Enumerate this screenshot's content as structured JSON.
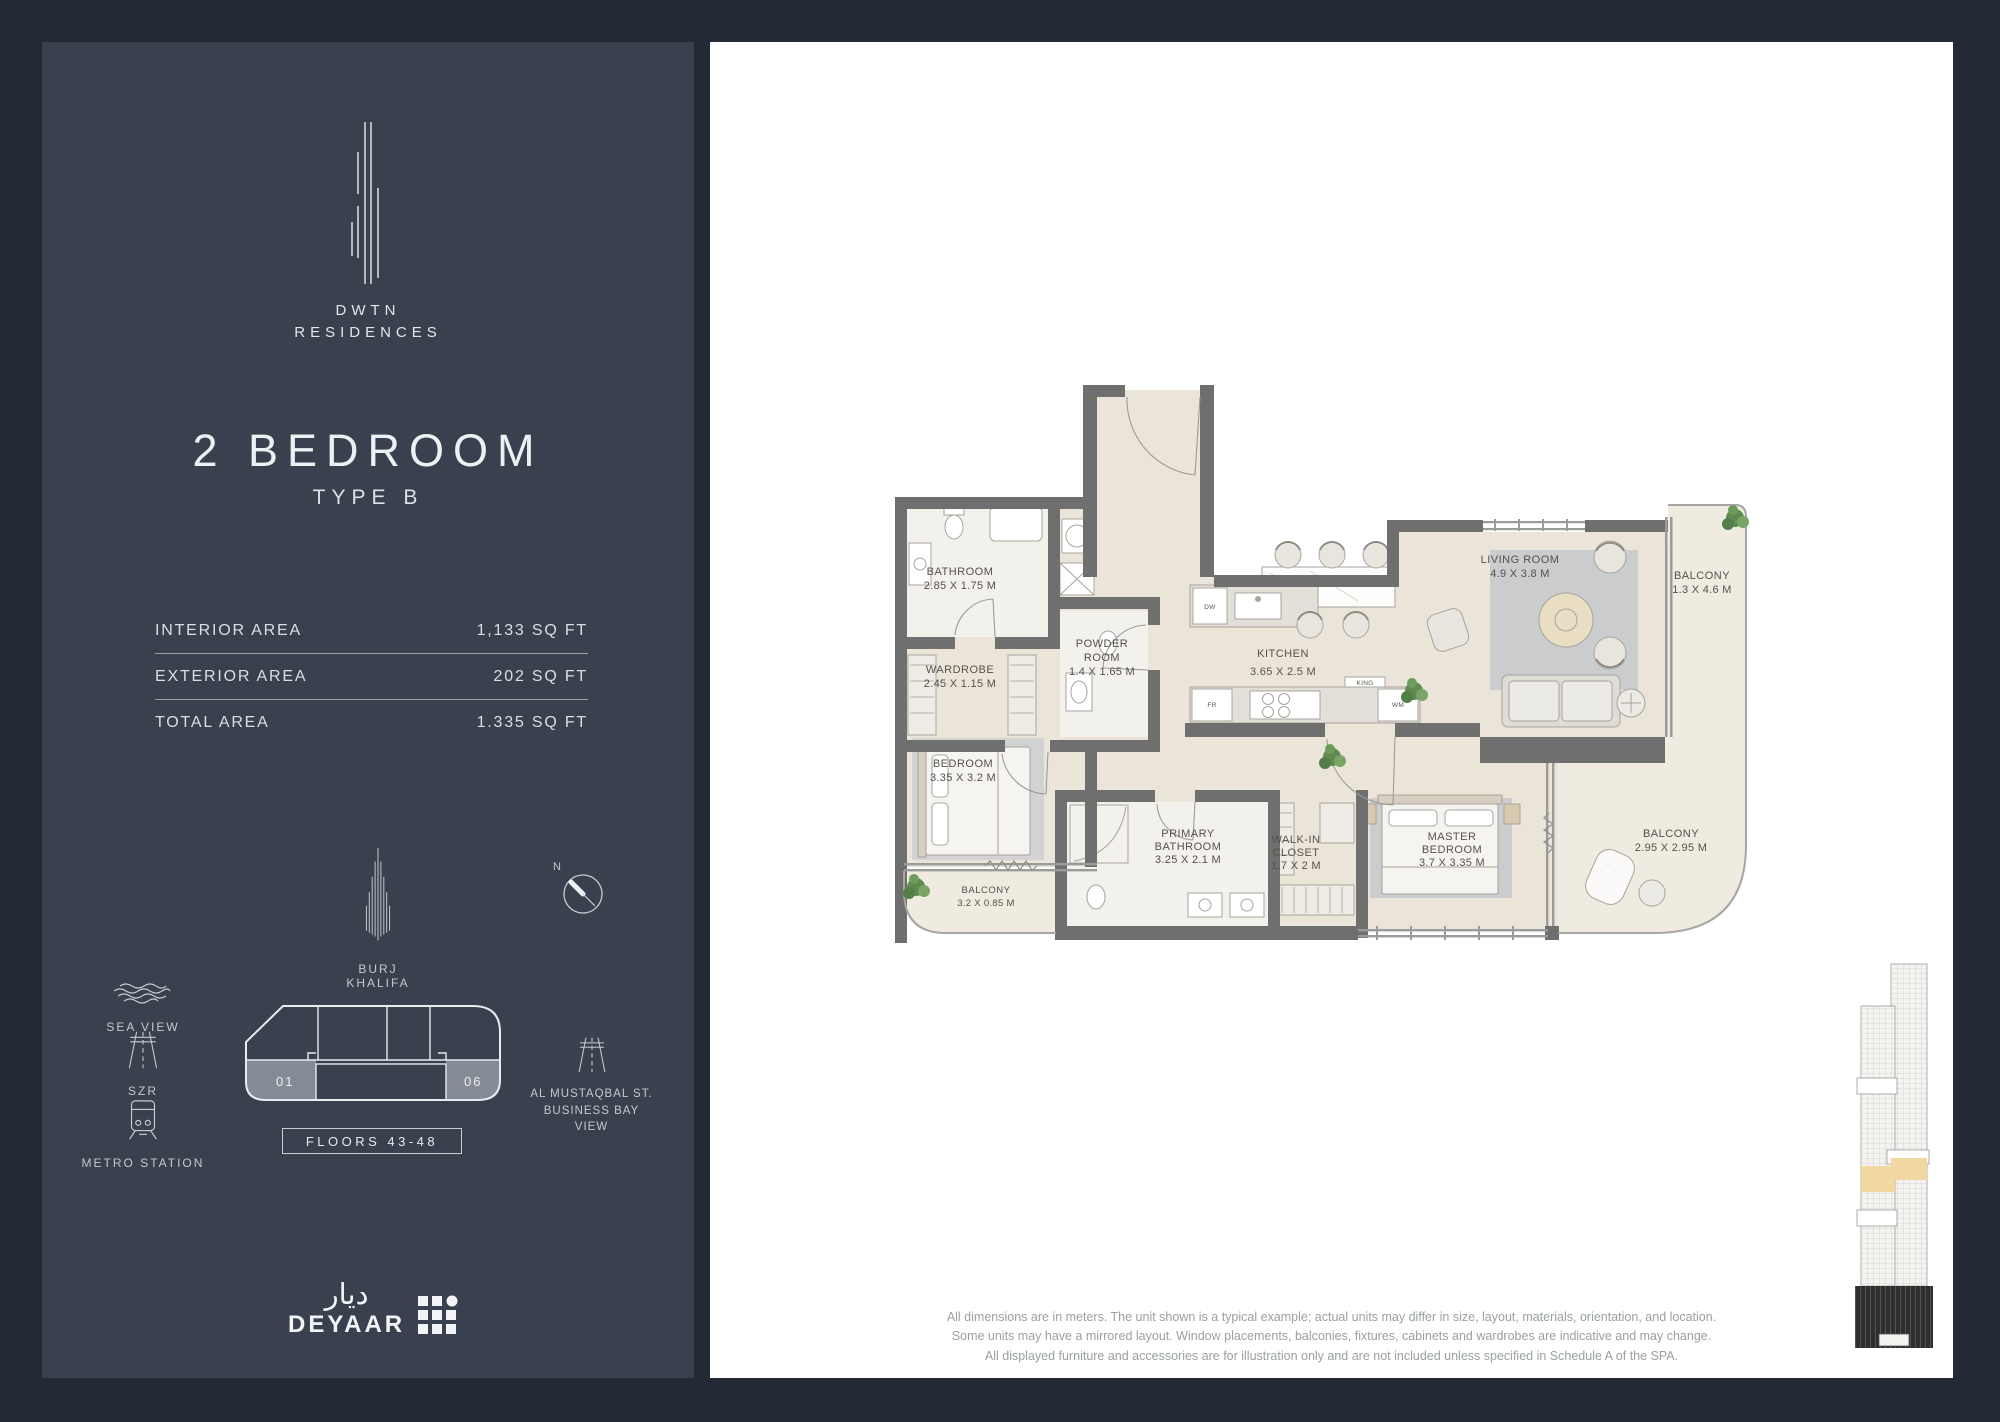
{
  "sidebar": {
    "brand_line1": "DWTN",
    "brand_line2": "RESIDENCES",
    "unit_title": "2 BEDROOM",
    "unit_subtitle": "TYPE B",
    "area_table": {
      "rows": [
        {
          "label": "INTERIOR AREA",
          "value": "1,133  SQ FT"
        },
        {
          "label": "EXTERIOR AREA",
          "value": "202  SQ FT"
        },
        {
          "label": "TOTAL AREA",
          "value": "1.335  SQ FT"
        }
      ]
    },
    "landmark_label": "BURJ KHALIFA",
    "compass_north": "N",
    "context_items": [
      {
        "icon": "sea-waves-icon",
        "label": "SEA VIEW"
      },
      {
        "icon": "highway-icon",
        "label": "SZR"
      },
      {
        "icon": "metro-train-icon",
        "label": "METRO STATION"
      }
    ],
    "floorplate": {
      "unit_left": "01",
      "unit_right": "06",
      "floors_badge": "FLOORS 43-48",
      "street_label": "AL MUSTAQBAL ST.\nBUSINESS BAY\nVIEW"
    },
    "developer": {
      "arabic": "ديار",
      "name": "DEYAAR"
    }
  },
  "plan": {
    "rooms": [
      {
        "line1": "BATHROOM",
        "dims": "2.85 X 1.75 M"
      },
      {
        "line1": "WARDROBE",
        "dims": "2.45 X 1.15 M"
      },
      {
        "line1": "POWDER",
        "line2": "ROOM",
        "dims": "1.4 X 1.65 M"
      },
      {
        "line1": "KITCHEN",
        "dims": "3.65 X 2.5 M"
      },
      {
        "line1": "LIVING ROOM",
        "dims": "4.9 X 3.8 M"
      },
      {
        "line1": "BALCONY",
        "dims": "1.3 X 4.6 M"
      },
      {
        "line1": "BEDROOM",
        "dims": "3.35 X 3.2 M"
      },
      {
        "line1": "BALCONY",
        "dims": "3.2 X 0.85 M"
      },
      {
        "line1": "PRIMARY",
        "line2": "BATHROOM",
        "dims": "3.25 X 2.1 M"
      },
      {
        "line1": "WALK-IN",
        "line2": "CLOSET",
        "dims": "1.7 X 2 M"
      },
      {
        "line1": "MASTER",
        "line2": "BEDROOM",
        "dims": "3.7 X 3.35 M"
      },
      {
        "line1": "BALCONY",
        "dims": "2.95 X 2.95 M"
      }
    ],
    "labels": {
      "dw": "DW",
      "fr": "FR",
      "wm": "WM",
      "king": "KING"
    }
  },
  "disclaimer": {
    "lines": [
      "All dimensions are in meters. The unit shown is a typical example; actual units may differ in size, layout, materials, orientation, and location.",
      "Some units may have a mirrored layout. Window placements, balconies, fixtures, cabinets and wardrobes are indicative and may change.",
      "All displayed furniture and accessories are for illustration only and are not included unless specified in Schedule A of the SPA."
    ]
  }
}
